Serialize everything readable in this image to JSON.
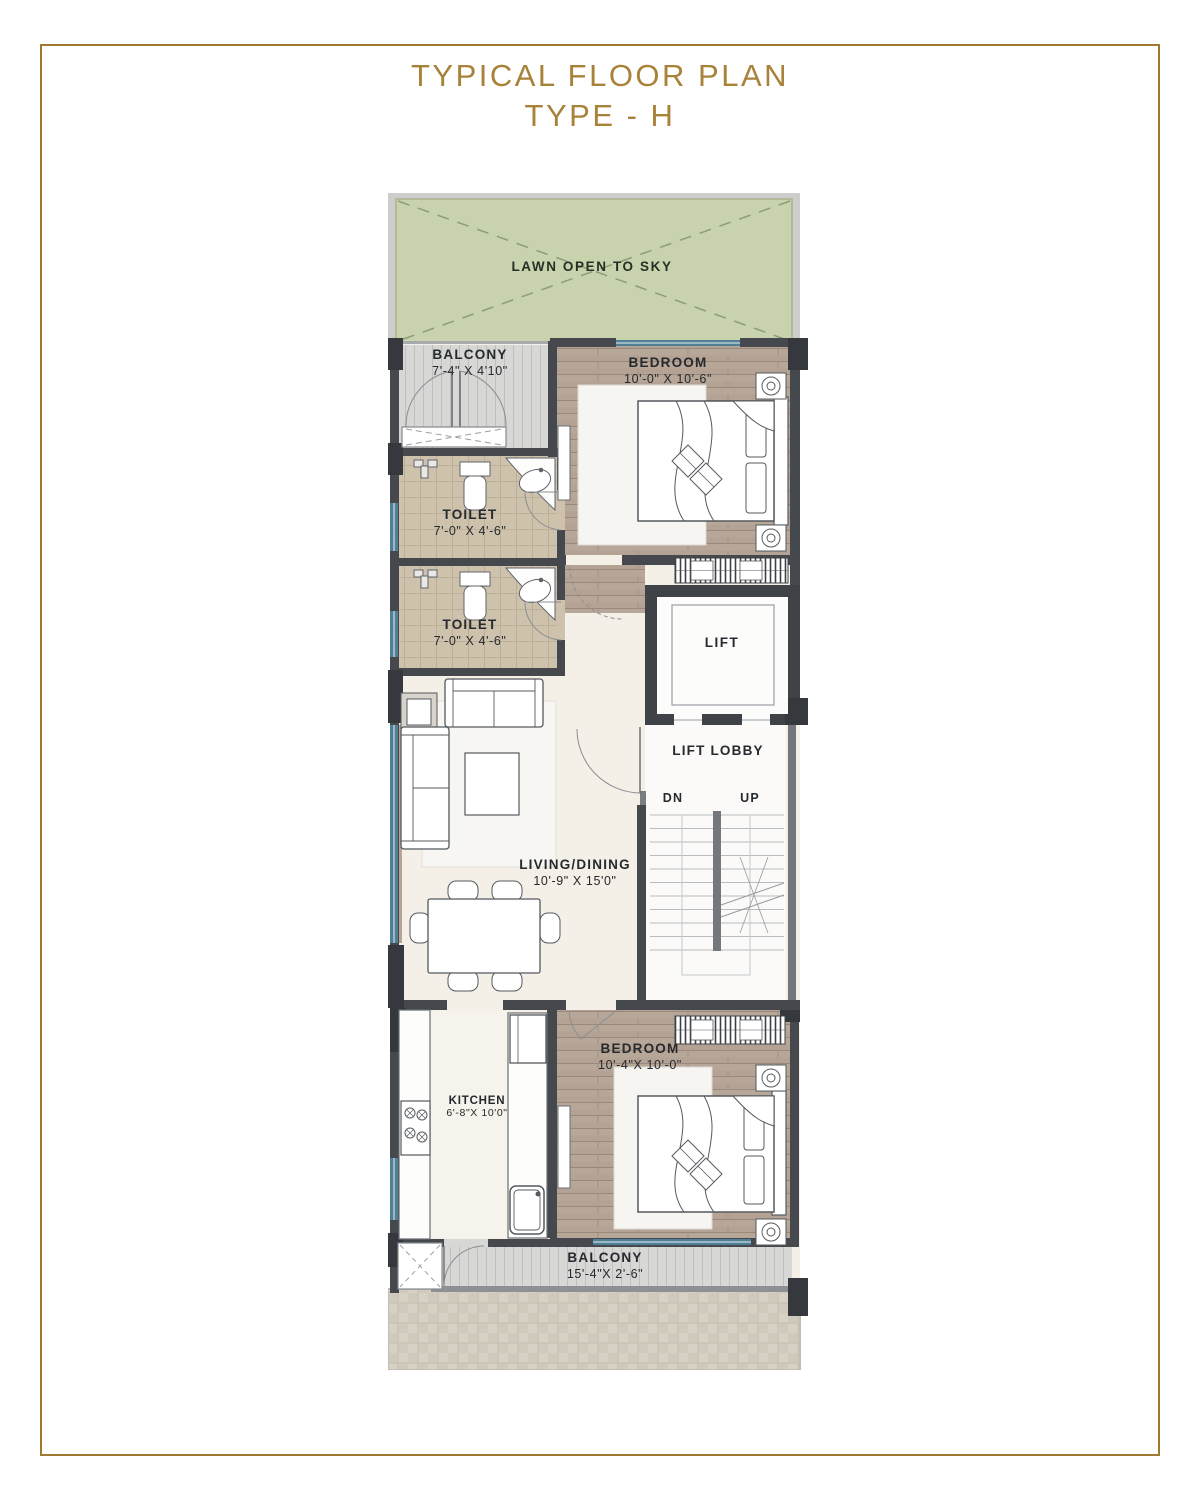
{
  "title": {
    "line1": "TYPICAL FLOOR PLAN",
    "line2": "TYPE - H"
  },
  "lawn": {
    "label": "LAWN OPEN TO SKY"
  },
  "rooms": {
    "balcony_top": {
      "name": "BALCONY",
      "dims": "7'-4\" X 4'10\""
    },
    "bedroom_top": {
      "name": "BEDROOM",
      "dims": "10'-0\" X 10'-6\""
    },
    "toilet_1": {
      "name": "TOILET",
      "dims": "7'-0\" X 4'-6\""
    },
    "toilet_2": {
      "name": "TOILET",
      "dims": "7'-0\" X 4'-6\""
    },
    "lift": {
      "name": "LIFT"
    },
    "lift_lobby": {
      "name": "LIFT LOBBY"
    },
    "stairs": {
      "down_label": "DN",
      "up_label": "UP"
    },
    "living_dining": {
      "name": "LIVING/DINING",
      "dims": "10'-9\" X 15'0\""
    },
    "kitchen": {
      "name": "KITCHEN",
      "dims": "6'-8\"X 10'0\""
    },
    "bedroom_bottom": {
      "name": "BEDROOM",
      "dims": "10'-4\"X 10'-0\""
    },
    "balcony_bottom": {
      "name": "BALCONY",
      "dims": "15'-4\"X 2'-6\""
    }
  },
  "colors": {
    "frame": "#9d7a2f",
    "title": "#a9823a",
    "wall": "#45484c",
    "wall_light": "#74787c",
    "window": "#508095",
    "lawn": "#c8d3ae",
    "wood": "#b4a395",
    "tile": "#cec2ad",
    "deck": "#d7d7d5",
    "floor": "#f4f0e8",
    "paved": "#d7d1c5"
  }
}
